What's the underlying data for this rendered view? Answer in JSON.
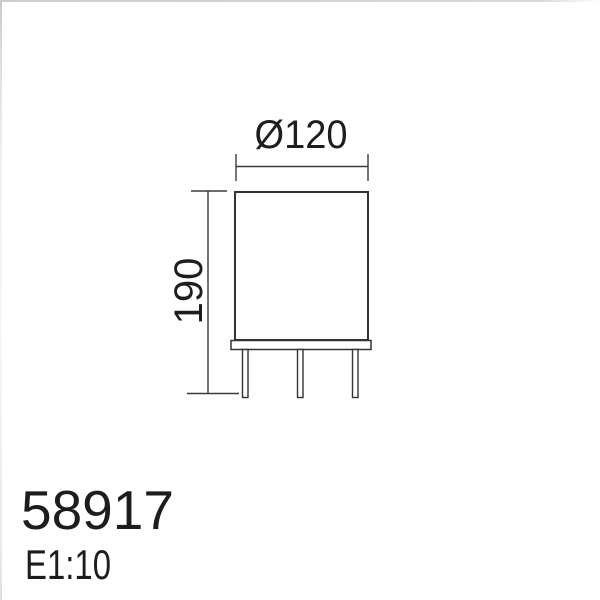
{
  "colors": {
    "background": "#ffffff",
    "drawing_line": "#3a3a3a",
    "text": "#1d1d1d",
    "edge_border": "#d4d4d4"
  },
  "drawing": {
    "width_dimension": {
      "label": "Ø120"
    },
    "height_dimension": {
      "label": "190"
    }
  },
  "footer": {
    "article_number": "58917",
    "scale": "E1:10"
  }
}
